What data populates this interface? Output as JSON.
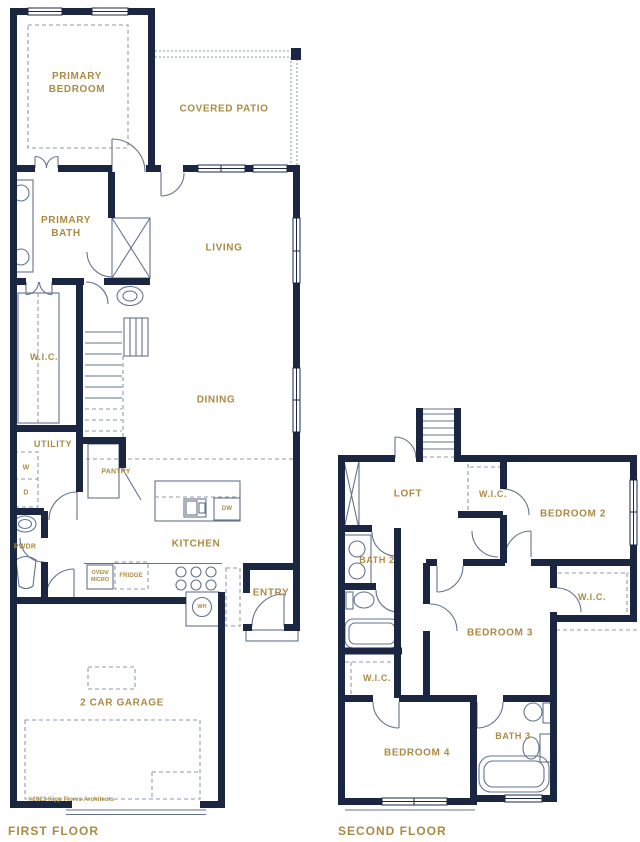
{
  "document": {
    "type": "architectural floor plan"
  },
  "colors": {
    "wall": "#1b2742",
    "accent": "#ab8b43",
    "line": "#64738c",
    "dash": "#8e9aac"
  },
  "first_floor": {
    "title": "FIRST FLOOR",
    "copyright": "©2023 Kipp Flores Architects",
    "rooms": {
      "primary_bedroom": "PRIMARY BEDROOM",
      "covered_patio": "COVERED PATIO",
      "primary_bath": "PRIMARY BATH",
      "living": "LIVING",
      "wic": "W.I.C.",
      "dining": "DINING",
      "utility": "UTILITY",
      "pantry": "PANTRY",
      "pwdr": "PWDR",
      "kitchen": "KITCHEN",
      "entry": "ENTRY",
      "garage": "2 CAR GARAGE"
    },
    "fixtures": {
      "washer": "W",
      "dryer": "D",
      "oven_micro": "OVEN/ MICRO",
      "fridge": "FRIDGE",
      "dishwasher": "DW",
      "water_heater": "WH"
    }
  },
  "second_floor": {
    "title": "SECOND FLOOR",
    "rooms": {
      "loft": "LOFT",
      "wic_top": "W.I.C.",
      "bedroom2": "BEDROOM 2",
      "bath2": "BATH 2",
      "wic_right": "W.I.C.",
      "bedroom3": "BEDROOM 3",
      "wic_left": "W.I.C.",
      "bedroom4": "BEDROOM 4",
      "bath3": "BATH 3"
    }
  }
}
